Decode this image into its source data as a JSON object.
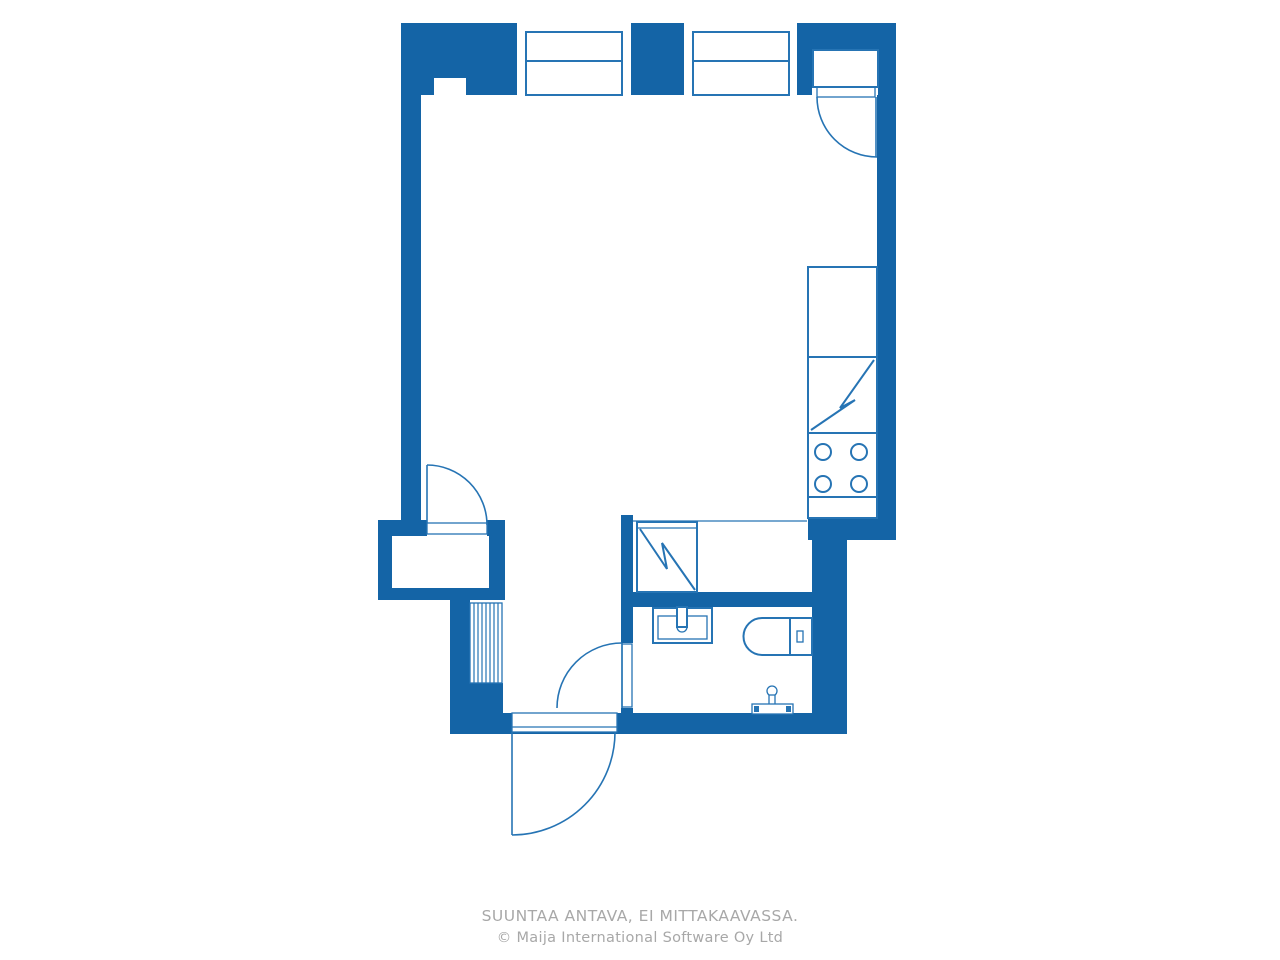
{
  "caption": {
    "line1": "SUUNTAA ANTAVA, EI MITTAKAAVASSA.",
    "line2": "© Maija International Software Oy Ltd"
  },
  "colors": {
    "wall": "#1464a6",
    "line": "#2674b4",
    "caption": "#a8a8a8",
    "bg": "#ffffff"
  },
  "floor_plan": {
    "type": "studio-apartment-floor-plan",
    "fixtures": [
      "window",
      "window",
      "balcony-door",
      "kitchen-counter",
      "refrigerator",
      "stove",
      "closet",
      "wardrobe-rack",
      "interior-door",
      "bathroom-door",
      "entry-door",
      "bathroom-sink",
      "toilet",
      "shower-mixer"
    ]
  }
}
